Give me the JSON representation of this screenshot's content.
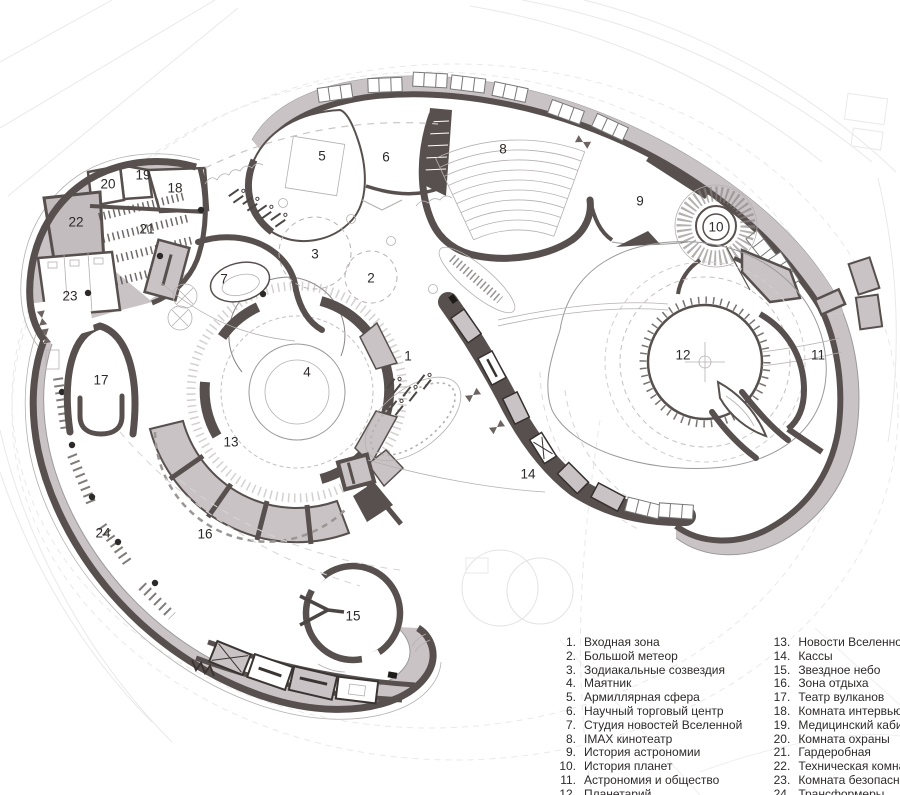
{
  "colors": {
    "wall": "#57504e",
    "room": "#cac3c6",
    "room_light": "#d8d2d4",
    "line": "#9a9a9a",
    "faint": "#e9e9e9",
    "text": "#2d2a29",
    "background": "#ffffff"
  },
  "plan": {
    "labels": [
      {
        "n": "1",
        "x": 408,
        "y": 356
      },
      {
        "n": "2",
        "x": 371,
        "y": 278
      },
      {
        "n": "3",
        "x": 315,
        "y": 254
      },
      {
        "n": "4",
        "x": 307,
        "y": 372
      },
      {
        "n": "5",
        "x": 322,
        "y": 156
      },
      {
        "n": "6",
        "x": 386,
        "y": 157
      },
      {
        "n": "7",
        "x": 224,
        "y": 279
      },
      {
        "n": "8",
        "x": 503,
        "y": 149
      },
      {
        "n": "9",
        "x": 640,
        "y": 201
      },
      {
        "n": "10",
        "x": 716,
        "y": 227
      },
      {
        "n": "11",
        "x": 818,
        "y": 355
      },
      {
        "n": "12",
        "x": 683,
        "y": 355
      },
      {
        "n": "13",
        "x": 231,
        "y": 442
      },
      {
        "n": "14",
        "x": 528,
        "y": 474
      },
      {
        "n": "15",
        "x": 353,
        "y": 616
      },
      {
        "n": "16",
        "x": 205,
        "y": 534
      },
      {
        "n": "17",
        "x": 101,
        "y": 380
      },
      {
        "n": "18",
        "x": 175,
        "y": 188
      },
      {
        "n": "19",
        "x": 143,
        "y": 175
      },
      {
        "n": "20",
        "x": 108,
        "y": 184
      },
      {
        "n": "21",
        "x": 147,
        "y": 229
      },
      {
        "n": "22",
        "x": 76,
        "y": 222
      },
      {
        "n": "23",
        "x": 70,
        "y": 296
      },
      {
        "n": "24",
        "x": 103,
        "y": 533
      }
    ]
  },
  "legend": {
    "items": [
      {
        "num": "1.",
        "label": "Входная зона"
      },
      {
        "num": "2.",
        "label": "Большой метеор"
      },
      {
        "num": "3.",
        "label": "Зодиакальные созвездия"
      },
      {
        "num": "4.",
        "label": "Маятник"
      },
      {
        "num": "5.",
        "label": "Армиллярная сфера"
      },
      {
        "num": "6.",
        "label": "Научный торговый центр"
      },
      {
        "num": "7.",
        "label": "Студия новостей Вселенной"
      },
      {
        "num": "8.",
        "label": "IMAX кинотеатр"
      },
      {
        "num": "9.",
        "label": "История астрономии"
      },
      {
        "num": "10.",
        "label": "История планет"
      },
      {
        "num": "11.",
        "label": "Астрономия и общество"
      },
      {
        "num": "12.",
        "label": "Планетарий"
      },
      {
        "num": "13.",
        "label": "Новости Вселенной"
      },
      {
        "num": "14.",
        "label": "Кассы"
      },
      {
        "num": "15.",
        "label": "Звездное небо"
      },
      {
        "num": "16.",
        "label": "Зона отдыха"
      },
      {
        "num": "17.",
        "label": "Театр вулканов"
      },
      {
        "num": "18.",
        "label": "Комната интервью"
      },
      {
        "num": "19.",
        "label": "Медицинский кабинет"
      },
      {
        "num": "20.",
        "label": "Комната охраны"
      },
      {
        "num": "21.",
        "label": "Гардеробная"
      },
      {
        "num": "22.",
        "label": "Техническая комната"
      },
      {
        "num": "23.",
        "label": "Комната безопасности"
      },
      {
        "num": "24.",
        "label": "Трансформеры"
      }
    ]
  }
}
